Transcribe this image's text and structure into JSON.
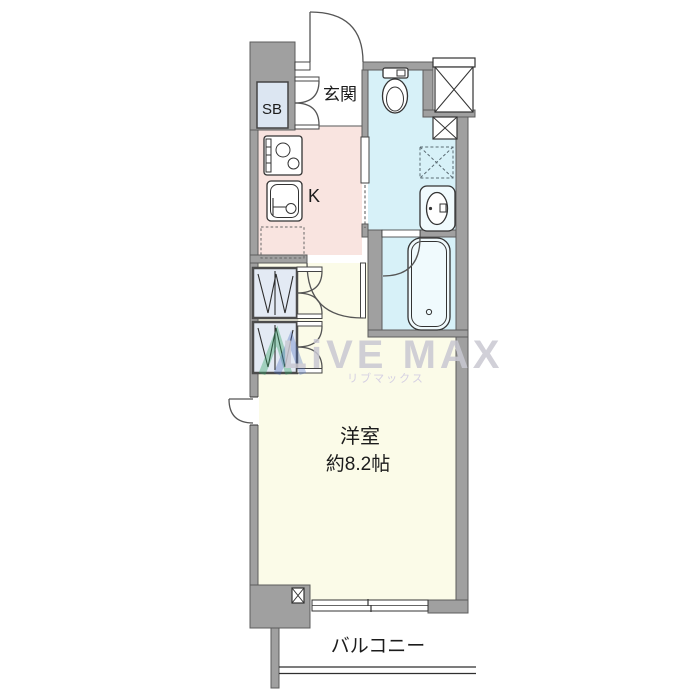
{
  "floorplan": {
    "labels": {
      "entrance": "玄関",
      "shoe_box": "SB",
      "kitchen": "K",
      "room_name": "洋室",
      "room_size": "約8.2帖",
      "balcony": "バルコニー"
    },
    "watermark": {
      "brand": "LiVE MAX",
      "brand_kana": "リブマックス"
    },
    "colors": {
      "wall": "#a0a0a0",
      "kitchen": "#f9e4e0",
      "sanitary": "#d7f1f8",
      "room": "#fbfbe8",
      "closet": "#e3eaf4",
      "shoebox": "#dce6f2",
      "watermark": "#c9c8d2"
    }
  }
}
